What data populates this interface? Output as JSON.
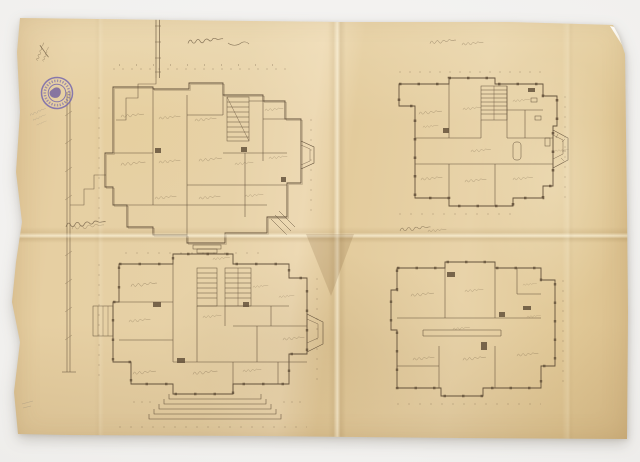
{
  "meta": {
    "title": "Photographed sheet of historical architectural floor plans",
    "description": "An aged, yellowed folded drawing sheet photographed on a light grey surface. It bears four hand-drawn ink floor plans (two larger plans on the left, two simpler plans on the right), cursive handwritten captions, dimension lines, a round violet ink stamp and faint pencil notes.",
    "handwriting_note": "All captions, room labels, dimensions and stamp rim text are tiny faded cursive script and are not legible at this resolution."
  },
  "colors": {
    "photo_background": "#f1f0ee",
    "paper": "#e5cda0",
    "ink": "#5a4833",
    "stamp_violet": "#7264ae",
    "pencil": "#8f887c"
  },
  "sheet": {
    "condition": [
      "yellowed",
      "vertical center fold crease",
      "horizontal center fold crease",
      "worn wavy left edge",
      "curled top-right corner",
      "central crease shadow"
    ],
    "stamp": {
      "shape": "round",
      "rings": 2,
      "rim_text": "illegible",
      "center": "dark violet blob",
      "position": "upper left"
    },
    "handwritten_marks": [
      {
        "name": "ink-inventory-number",
        "position": "top-left edge, written diagonally",
        "legible": false
      },
      {
        "name": "pencil-note",
        "position": "below the round stamp",
        "legible": false
      },
      {
        "name": "pencil-tick",
        "position": "lower-left margin",
        "legible": false
      }
    ],
    "boundary_line": "thin surveyed boundary/fence line running down the left side of the sheet"
  },
  "plans": [
    {
      "id": "upper-left",
      "caption_script": "illegible cursive caption above plan",
      "aria": "Upper-left floor plan: large irregular villa floor with hatched central staircase, many labelled rooms, bay window on the right and dimension ticks around the outline"
    },
    {
      "id": "upper-right",
      "caption_script": "illegible two-word cursive caption above plan",
      "aria": "Upper-right floor plan: rectangular floor with hatched stair at top, labelled rooms, bathroom fixtures and a half-octagonal terrace bay on the right"
    },
    {
      "id": "lower-left",
      "caption_script": "illegible cursive caption on the fold at left",
      "aria": "Lower-left floor plan: main floor with two hatched staircases, labelled rooms, right-hand bay window, left porch and a wide fan of entrance steps at the bottom"
    },
    {
      "id": "lower-right",
      "caption_script": "illegible cursive caption above plan",
      "aria": "Lower-right floor plan: simple rectangular floor with labelled rooms and a long central passage"
    }
  ]
}
